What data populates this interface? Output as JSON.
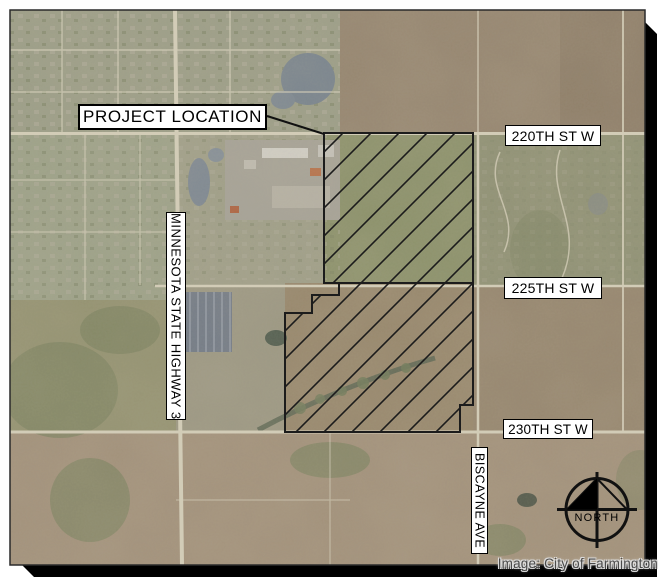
{
  "figure": {
    "type": "aerial-project-location-map",
    "annotation_labels": {
      "project_location": "PROJECT LOCATION",
      "street_220": "220TH ST W",
      "street_225": "225TH ST W",
      "street_230": "230TH ST W",
      "highway_3": "MINNESOTA STATE HIGHWAY 3",
      "biscayne_ave": "BISCAYNE AVE"
    },
    "compass": {
      "label": "NORTH"
    },
    "credit": "Image: City of Farmington",
    "colors": {
      "label_background": "#ffffff",
      "label_border": "#000000",
      "label_text": "#000000",
      "hatch_line": "#1c1c1c",
      "boundary_line": "#1c1c1c",
      "drop_shadow": "#000000",
      "credit_text": "#4a4a4a",
      "road": "#d2ccb7"
    }
  }
}
